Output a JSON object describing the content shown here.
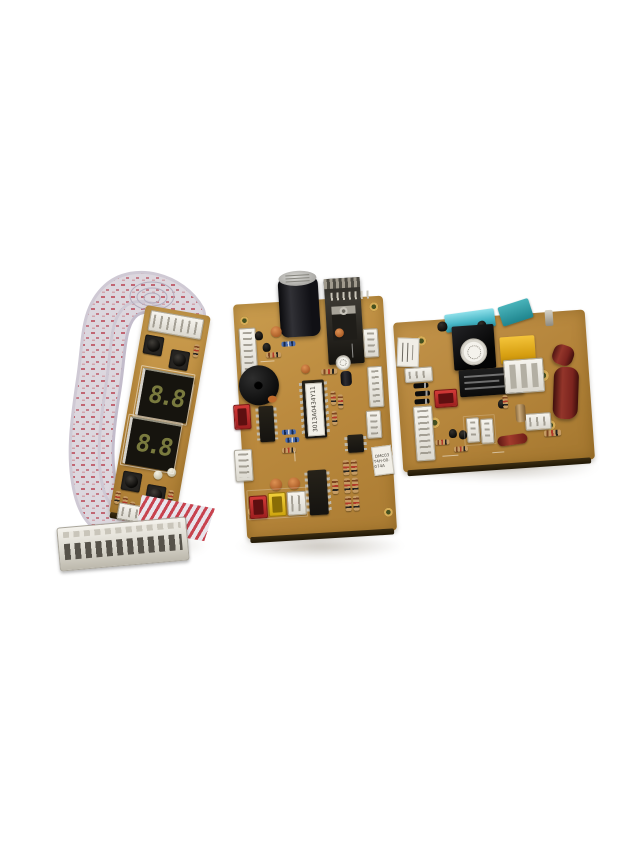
{
  "scene": {
    "description": "Product photograph of three appliance control PCBs (display board with ribbon cable, main control board, power/relay board) on a white background",
    "background_color": "#ffffff"
  },
  "boards": {
    "display_board": {
      "name": "display board with ribbon cable",
      "pcb_color": "#c2924a",
      "digits": "8.8",
      "components": [
        "2-digit 7-segment LED display x2",
        "tactile push button x4",
        "white pin connector x2",
        "flat ribbon cable with white plug",
        "resistors",
        "clear LEDs"
      ]
    },
    "main_board": {
      "name": "main control board",
      "pcb_color": "#bb8a3e",
      "ic_label": "3013A0434Y11",
      "sticker_line1": "DMC03",
      "sticker_line2": "T4H-00-074A",
      "components": [
        "electrolytic capacitor",
        "heatsink with TO-220 regulator",
        "piezo buzzer",
        "DIP-28 microcontroller",
        "DIP-16 driver ICs",
        "8-pin EEPROM",
        "white header connectors",
        "red / yellow / white wire connectors",
        "ceramic disc capacitors",
        "resistors"
      ]
    },
    "power_board": {
      "name": "power relay board",
      "pcb_color": "#b9893d",
      "components": [
        "transformer with round sticker",
        "power relay",
        "yellow film capacitor",
        "cyan film capacitor",
        "teal film capacitor",
        "red fuse sleeves",
        "bridge diodes x4",
        "red connector",
        "white connectors",
        "mounting holes"
      ]
    }
  },
  "colors": {
    "pcb": "#bb8a3e",
    "ribbon": "#d9d4db",
    "ribbon_stripe": "#b23a48",
    "segment_glow": "#9a9c4e",
    "relay_black": "#141414",
    "fuse_red": "#7d241f",
    "cap_cyan": "#63ccda",
    "cap_teal": "#2f9aa3",
    "cap_yellow": "#e8b11c",
    "connector_white": "#eceae2",
    "connector_red": "#c0272d",
    "connector_yellow": "#e6c019"
  }
}
